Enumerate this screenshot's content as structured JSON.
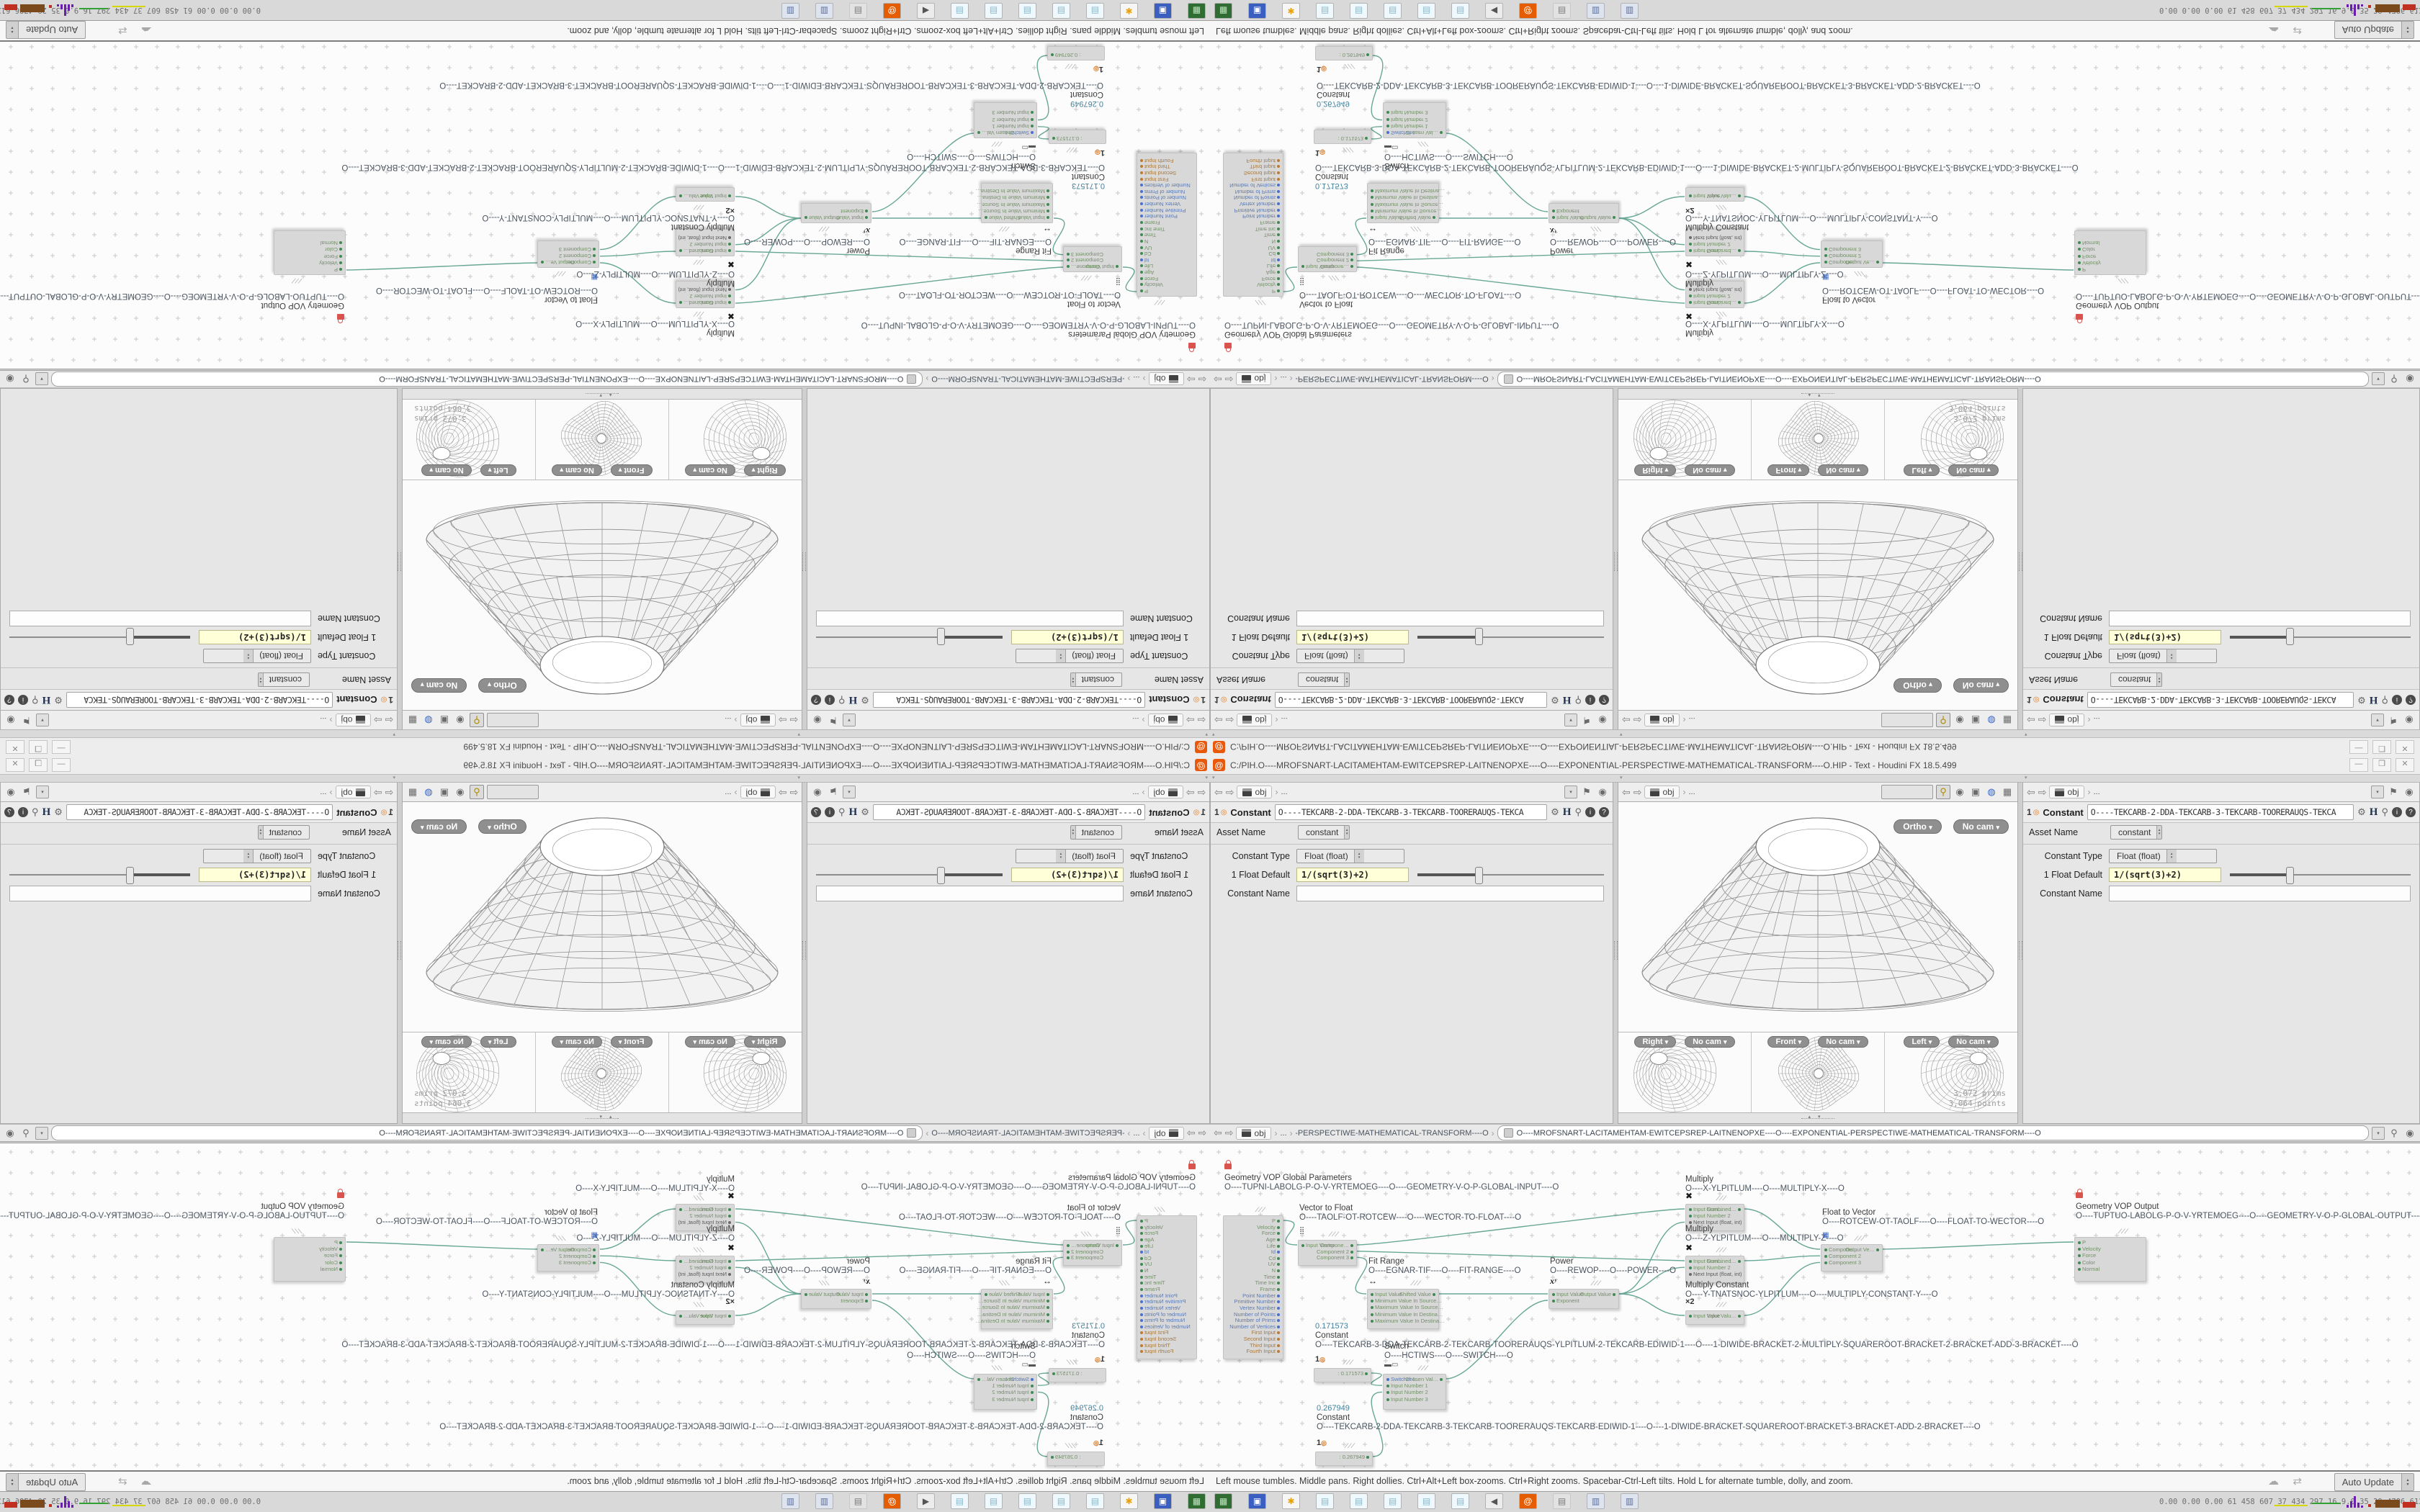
{
  "window": {
    "title": "C:/PIH.O----MROFSNART-LACITAMEHTAM-EWITCEPSREP-LAITNENOPXE----O----EXPONENTIAL-PERSPECTIWE-MATHEMATICAL-TRANSFORM----O.HIP - Text - Houdini FX 18.5.499",
    "minimize": "—",
    "restore": "❐",
    "close": "✕"
  },
  "icons": {
    "back": "⇦",
    "forward": "⇨",
    "chevron": "›",
    "more": "...",
    "dropdown": "▾",
    "pin": "⚑",
    "target": "◉",
    "lamp": "⚲",
    "cube": "▣",
    "sphere": "◍",
    "grid": "▦",
    "gear": "⚙",
    "hscript": "H",
    "magnifier": "⚲",
    "info": "i",
    "help": "?",
    "spin_up": "▴",
    "spin_down": "▾",
    "menu_arrow": "▾",
    "brain": "☁",
    "sync": "⇄",
    "playbar": "▴▾",
    "vop_glyph": "❖"
  },
  "breadcrumb": {
    "root": "obj"
  },
  "param_panel": {
    "node_type": "Constant",
    "node_path": "O----TEKCARB-2-DDA-TEKCARB-3-TEKCARB-TOORERAUQS-TEKCA",
    "rows": [
      {
        "label": "Asset Name",
        "value": "constant",
        "control": "combo-small"
      },
      {
        "label": "Constant Type",
        "value": "Float (float)",
        "control": "combo"
      },
      {
        "label": "1 Float Default",
        "value": "1/(sqrt(3)+2)",
        "control": "expr-slider"
      },
      {
        "label": "Constant Name",
        "value": "",
        "control": "input"
      }
    ]
  },
  "viewport": {
    "main_view": "Ortho",
    "cam": "No cam",
    "subviews": [
      "Right",
      "Front",
      "Left"
    ],
    "stats_prims": "3,072  prims",
    "stats_points": "3,064 points"
  },
  "network_path": {
    "parent": "O----MROFSNART-LACITAMEHTAM-EWITCEPSREP-LAITNENOPXE----O----EXPONENTIAL-PERSPECTIWE-MATHEMATICAL-TRANSFORM----O",
    "current": "O----MROFSNART-LACITAMEHTAM-EWITCEPSREP-LAITNENOPXE----O----EXPONENTIAL-PERSPECTIWE-MATHEMATICAL-TRANSFORM----O"
  },
  "network": {
    "nodes": [
      {
        "id": "geo_in",
        "title": "Geometry VOP Global Parameters",
        "name": "O----TUPNI-LABOLG-P-O-V-YRTEMOEG----O----GEOMETRY-V-O-P-GLOBAL-INPUT----O",
        "icon": "lock",
        "inputs": [],
        "outputs": [
          {
            "t": "P",
            "c": "g"
          },
          {
            "t": "Velocity",
            "c": "g"
          },
          {
            "t": "Force",
            "c": "g"
          },
          {
            "t": "Age",
            "c": "g"
          },
          {
            "t": "Life",
            "c": "g"
          },
          {
            "t": "Id",
            "c": "b"
          },
          {
            "t": "Cd",
            "c": "g"
          },
          {
            "t": "UV",
            "c": "g"
          },
          {
            "t": "N",
            "c": "g"
          },
          {
            "t": "Time",
            "c": "g"
          },
          {
            "t": "Time Inc",
            "c": "g"
          },
          {
            "t": "Frame",
            "c": "g"
          },
          {
            "t": "Point Number",
            "c": "b"
          },
          {
            "t": "Primitive Number",
            "c": "b"
          },
          {
            "t": "Vertex Number",
            "c": "b"
          },
          {
            "t": "Number of Points",
            "c": "b"
          },
          {
            "t": "Number of Prims",
            "c": "b"
          },
          {
            "t": "Number of Vertices",
            "c": "b"
          },
          {
            "t": "First Input",
            "c": "o"
          },
          {
            "t": "Second Input",
            "c": "o"
          },
          {
            "t": "Third Input",
            "c": "o"
          },
          {
            "t": "Fourth Input",
            "c": "o"
          }
        ]
      },
      {
        "id": "vec2flt",
        "title": "Vector to Float",
        "name": "O----TAOLF-OT-ROTCEW----O----WECTOR-TO-FLOAT----O",
        "icon": "ports",
        "inputs": [
          {
            "t": "Input Vector",
            "c": "g"
          }
        ],
        "outputs": [
          {
            "t": "Compone…",
            "c": "g"
          },
          {
            "t": "Component 2",
            "c": "g"
          },
          {
            "t": "Component 3",
            "c": "g"
          }
        ]
      },
      {
        "id": "fit",
        "title": "Fit Range",
        "name": "O----EGNAR-TIF----O----FIT-RANGE----O",
        "icon": "fit",
        "inputs": [
          {
            "t": "Input Value",
            "c": "g"
          },
          {
            "t": "Minimum Value In Source…",
            "c": "g"
          },
          {
            "t": "Maximum Value In Source…",
            "c": "g"
          },
          {
            "t": "Minimum Value In Destina…",
            "c": "g"
          },
          {
            "t": "Maximum Value In Destina…",
            "c": "g"
          }
        ],
        "outputs": [
          {
            "t": "Shifted Value",
            "c": "g"
          }
        ]
      },
      {
        "id": "power",
        "title": "Power",
        "name": "O----REWOP----O----POWER----O",
        "icon": "power",
        "inputs": [
          {
            "t": "Input Value",
            "c": "g"
          },
          {
            "t": "Exponent",
            "c": "g"
          }
        ],
        "outputs": [
          {
            "t": "Output Value",
            "c": "g"
          }
        ]
      },
      {
        "id": "const1",
        "value": "0.171573",
        "title": "Constant",
        "name": "O----TEKCARB-3-DDA-TEKCARB-2-TEKCARB-TOORERAUQS-YLPITLUM-2-TEKCARB-EDIWID-1----O----1-DIWIDE-BRACKET-2-MULTIPLY-SQUAREROOT-BRACKET-2-BRACKET-ADD-3-BRACKET----O",
        "icon": "badge",
        "inputs": [],
        "outputs": [
          {
            "t": ": 0.171573",
            "c": "g"
          }
        ]
      },
      {
        "id": "switch",
        "title": "Switch",
        "name": "O----HCTIWS----O----SWITCH----O",
        "icon": "switch",
        "inputs": [
          {
            "t": "Switcher I…",
            "c": "b"
          },
          {
            "t": "Input Number 1",
            "c": "g"
          },
          {
            "t": "Input Number 2",
            "c": "g"
          },
          {
            "t": "Input Number 3",
            "c": "g"
          }
        ],
        "outputs": [
          {
            "t": "Chosen Val…",
            "c": "g"
          }
        ]
      },
      {
        "id": "const2",
        "value": "0.267949",
        "title": "Constant",
        "name": "O----TEKCARB-2-DDA-TEKCARB-3-TEKCARB-TOORERAUQS-TEKCARB-EDIWID-1----O----1-DIWIDE-BRACKET-SQUAREROOT-BRACKET-3-BRACKET-ADD-2-BRACKET----O",
        "icon": "badge",
        "inputs": [],
        "outputs": [
          {
            "t": ": 0.267949",
            "c": "g"
          }
        ]
      },
      {
        "id": "mulx",
        "title": "Multiply",
        "name": "O----X-YLPITLUM----O----MULTIPLY-X----O",
        "icon": "multiply",
        "inputs": [
          {
            "t": "Input Num…",
            "c": "g"
          },
          {
            "t": "Input Number 2",
            "c": "g"
          },
          {
            "t": "Next Input (float, int)",
            "c": "x"
          }
        ],
        "outputs": [
          {
            "t": "Combined…",
            "c": "g"
          }
        ]
      },
      {
        "id": "mulz",
        "title": "Multiply",
        "name": "O----Z-YLPITLUM----O----MULTIPLY-Z----O",
        "icon": "multiply",
        "inputs": [
          {
            "t": "Input Num…",
            "c": "g"
          },
          {
            "t": "Input Number 2",
            "c": "g"
          },
          {
            "t": "Next Input (float, int)",
            "c": "x"
          }
        ],
        "outputs": [
          {
            "t": "Combined…",
            "c": "g"
          }
        ]
      },
      {
        "id": "mulcy",
        "title": "Multiply Constant",
        "name": "O----Y-TNATSNOC-YLPITLUM----O----MULTIPLY-CONSTANT-Y----O",
        "icon": "multiply2",
        "inputs": [
          {
            "t": "Input Value",
            "c": "g"
          }
        ],
        "outputs": [
          {
            "t": "Input Valu…",
            "c": "g"
          }
        ]
      },
      {
        "id": "flt2vec",
        "title": "Float to Vector",
        "name": "O----ROTCEW-OT-TAOLF----O----FLOAT-TO-WECTOR----O",
        "icon": "ports2",
        "inputs": [
          {
            "t": "Compone…",
            "c": "g"
          },
          {
            "t": "Component 2",
            "c": "g"
          },
          {
            "t": "Component 3",
            "c": "g"
          }
        ],
        "outputs": [
          {
            "t": "Output Ve…",
            "c": "g"
          }
        ]
      },
      {
        "id": "geo_out",
        "title": "Geometry VOP Output",
        "name": "O----TUPTUO-LABOLG-P-O-V-YRTEMOEG----O----GEOMETRY-V-O-P-GLOBAL-OUTPUT----O",
        "icon": "lock",
        "inputs": [
          {
            "t": "P",
            "c": "g"
          },
          {
            "t": "Velocity",
            "c": "g"
          },
          {
            "t": "Force",
            "c": "g"
          },
          {
            "t": "Color",
            "c": "g"
          },
          {
            "t": "Normal",
            "c": "g"
          }
        ],
        "outputs": []
      }
    ]
  },
  "status": {
    "help": "Left mouse tumbles. Middle pans. Right dollies. Ctrl+Alt+Left box-zooms. Ctrl+Right zooms. Spacebar-Ctrl-Left tilts. Hold L for alternate tumble, dolly, and zoom.",
    "auto_update": "Auto Update"
  },
  "perf": {
    "numbers": [
      "0.00",
      "0.00",
      "0.00",
      "61",
      "458",
      "607",
      "37",
      "434",
      "297",
      "16",
      "9.0",
      "35",
      "29",
      "4786",
      "6123"
    ]
  },
  "shelf": [
    {
      "name": "scene-icon",
      "glyph": "▦",
      "cls": "sh-green"
    },
    {
      "name": "save-icon",
      "glyph": "▣",
      "cls": "sh-blue"
    },
    {
      "name": "spark-icon",
      "glyph": "✱",
      "cls": "sh-star"
    },
    {
      "name": "notes-icon",
      "glyph": "▤",
      "cls": "sh-note"
    },
    {
      "name": "notes-icon",
      "glyph": "▤",
      "cls": "sh-note"
    },
    {
      "name": "notes-icon",
      "glyph": "▤",
      "cls": "sh-note"
    },
    {
      "name": "notes-icon",
      "glyph": "▤",
      "cls": "sh-note"
    },
    {
      "name": "notes-icon",
      "glyph": "▤",
      "cls": "sh-note"
    },
    {
      "name": "audio-icon",
      "glyph": "◀",
      "cls": "sh-audio"
    },
    {
      "name": "houdini-icon",
      "glyph": "@",
      "cls": "sh-hou"
    },
    {
      "name": "render-icon",
      "glyph": "▤",
      "cls": "sh-dim"
    },
    {
      "name": "script-icon",
      "glyph": "▥",
      "cls": "sh-script"
    },
    {
      "name": "script-icon",
      "glyph": "▥",
      "cls": "sh-script"
    }
  ]
}
